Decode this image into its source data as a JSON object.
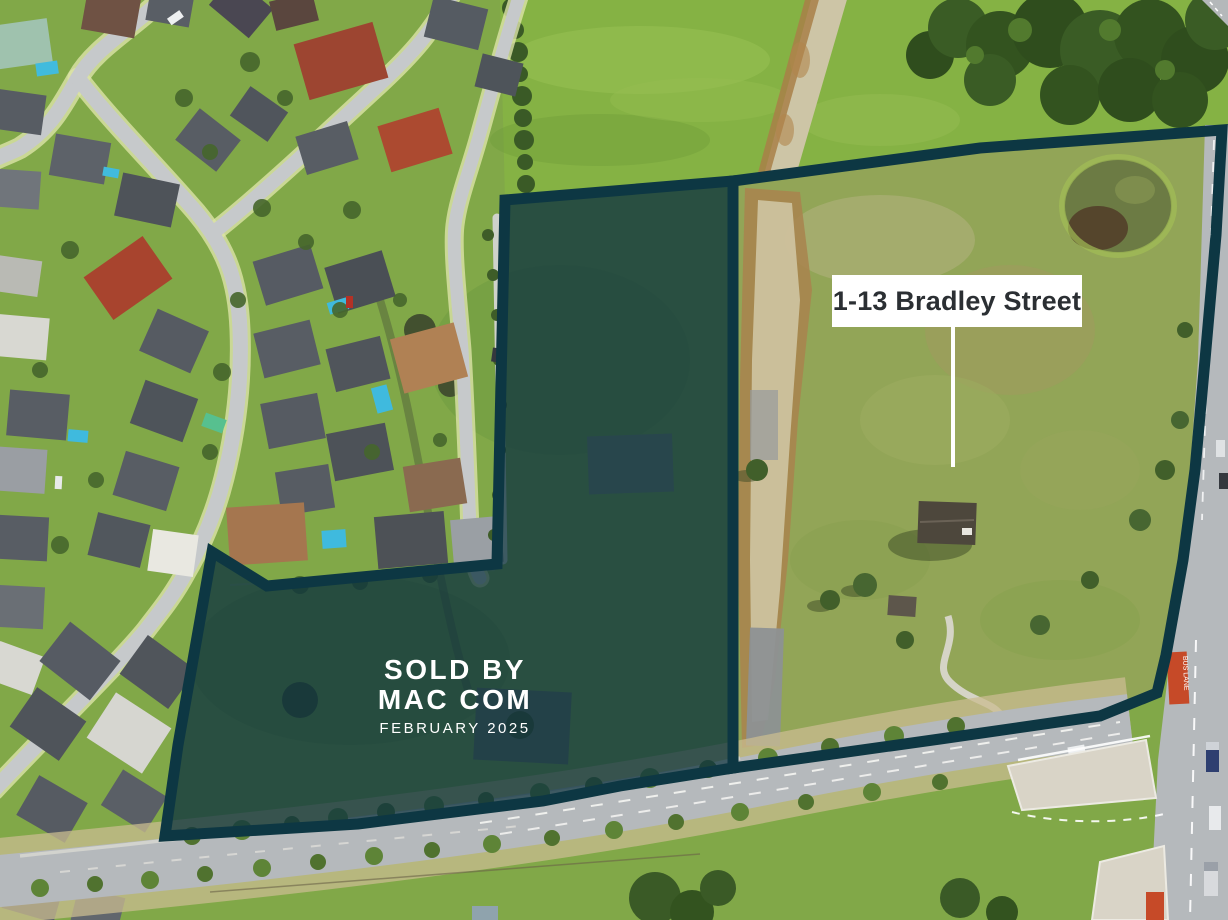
{
  "overlay": {
    "parcel_label": "1-13 Bradley Street",
    "sold_line1": "SOLD BY",
    "sold_line2": "MAC COM",
    "sold_line3": "FEBRUARY 2025"
  },
  "road_markings": {
    "bus_lane": "BUS LANE"
  },
  "colors": {
    "boundary_teal": "#0d3743",
    "parcel_shade_fill": "rgba(12,50,63,0.75)",
    "label_background": "#ffffff",
    "label_text": "#2b2f33",
    "sold_text": "#ffffff",
    "bus_lane_red": "#c64a28",
    "field_green": "#85b244",
    "road_grey": "#b5b9bc"
  }
}
